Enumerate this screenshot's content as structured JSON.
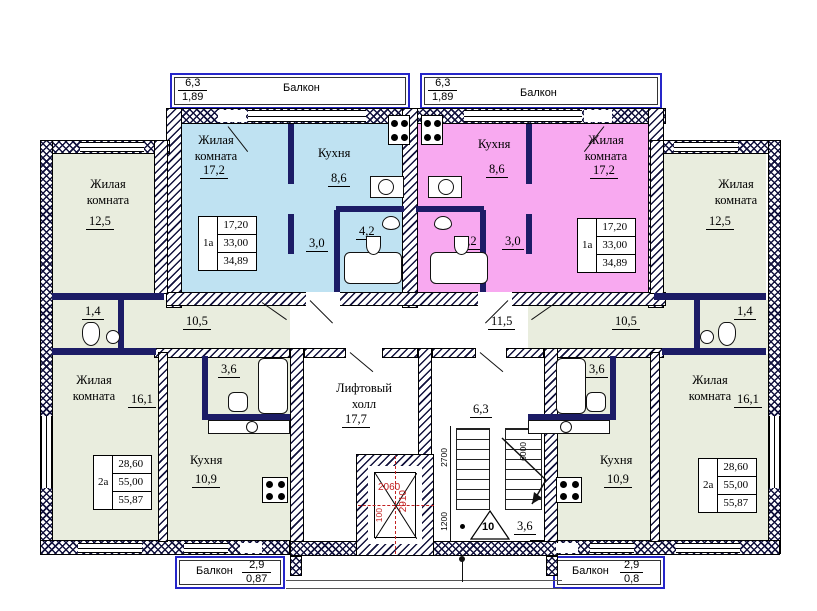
{
  "colors": {
    "studio_left_fill": "#bfe2f2",
    "studio_right_fill": "#f8a9f0",
    "wing_fill": "#e9edde",
    "wall": "#1c1c66",
    "red_dim": "#c22020",
    "balcony_rail": "#2626c9"
  },
  "balconies": {
    "top_left": {
      "label": "Балкон",
      "width": "6,3",
      "area": "1,89"
    },
    "top_right": {
      "label": "Балкон",
      "width": "6,3",
      "area": "1,89"
    },
    "bottom_left": {
      "label": "Балкон",
      "width": "2,9",
      "area": "0,87"
    },
    "bottom_right": {
      "label": "Балкон",
      "width": "2,9",
      "area": "0,8"
    }
  },
  "studio_left": {
    "living_label": "Жилая комната",
    "living_area": "17,2",
    "kitchen_label": "Кухня",
    "kitchen_area": "8,6",
    "hall_area": "3,0",
    "bath_area": "4,2",
    "stamp": {
      "type": "1а",
      "living": "17,20",
      "total": "33,00",
      "with_balcony": "34,89"
    }
  },
  "studio_right": {
    "living_label": "Жилая комната",
    "living_area": "17,2",
    "kitchen_label": "Кухня",
    "kitchen_area": "8,6",
    "hall_area": "3,0",
    "bath_area": "4,2",
    "stamp": {
      "type": "1а",
      "living": "17,20",
      "total": "33,00",
      "with_balcony": "34,89"
    }
  },
  "wing_left": {
    "room1_label": "Жилая комната",
    "room1_area": "12,5",
    "room2_label": "Жилая комната",
    "room2_area": "16,1",
    "kitchen_label": "Кухня",
    "kitchen_area": "10,9",
    "hall_area": "10,5",
    "wc_area": "1,4",
    "bath_area": "3,6",
    "stamp": {
      "type": "2а",
      "living": "28,60",
      "total": "55,00",
      "with_balcony": "55,87"
    }
  },
  "wing_right": {
    "room1_label": "Жилая комната",
    "room1_area": "12,5",
    "room2_label": "Жилая комната",
    "room2_area": "16,1",
    "kitchen_label": "Кухня",
    "kitchen_area": "10,9",
    "hall_area": "10,5",
    "wc_area": "1,4",
    "bath_area": "3,6",
    "stamp": {
      "type": "2а",
      "living": "28,60",
      "total": "55,00",
      "with_balcony": "55,87"
    }
  },
  "core": {
    "lift_hall_label": "Лифтовый холл",
    "lift_hall_area": "17,7",
    "entry_hall_area": "11,5",
    "shaft": {
      "dim_width": "2060",
      "dim_height": "2910",
      "dim_offset": "100"
    },
    "stairs": {
      "width": "6,3",
      "dim_left": "2700",
      "dim_right": "6000",
      "dim_bottom": "1200",
      "flight_steps": "10",
      "landing_width": "3,6"
    }
  }
}
